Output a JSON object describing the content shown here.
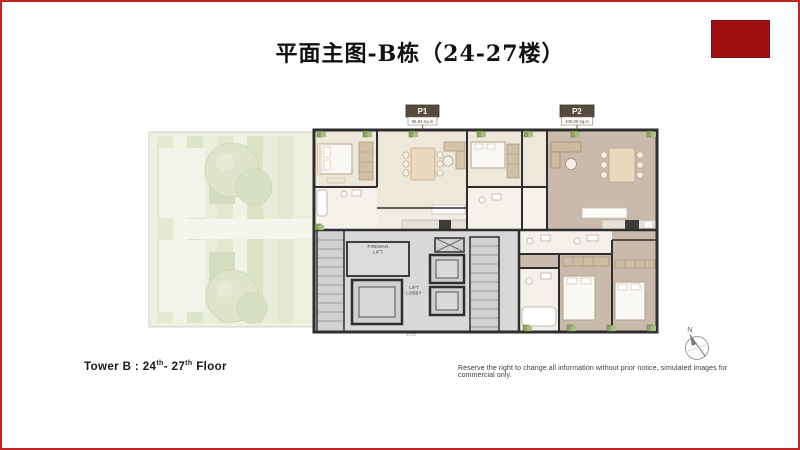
{
  "page": {
    "title": "平面主图-B栋（24-27楼）"
  },
  "plan": {
    "p1": {
      "code": "P1",
      "area": "96.83 Sq.m"
    },
    "p2": {
      "code": "P2",
      "area": "105.08 Sq.m"
    },
    "core": {
      "fireman_line1": "FIREMAN",
      "fireman_line2": "LIFT",
      "lobby_line1": "LIFT",
      "lobby_line2": "LOBBY",
      "dimension": "42.04"
    }
  },
  "compass": {
    "north_label": "N"
  },
  "footer": {
    "tower_prefix": "Tower B : 24",
    "sup1": "th",
    "tower_mid": "- 27",
    "sup2": "th",
    "tower_suffix": " Floor",
    "disclaimer": "Reserve the right to change all information without prior notice, simulated images for commercial only."
  },
  "colors": {
    "page_border": "#c12323",
    "accent_block": "#9e1112",
    "wall": "#2e2e2e",
    "floor_p1": "#eee8db",
    "floor_p2": "#cabaab",
    "core_gray": "#d8d8d8",
    "garden_green": "#eef0e2",
    "label_brown": "#564a3d"
  }
}
